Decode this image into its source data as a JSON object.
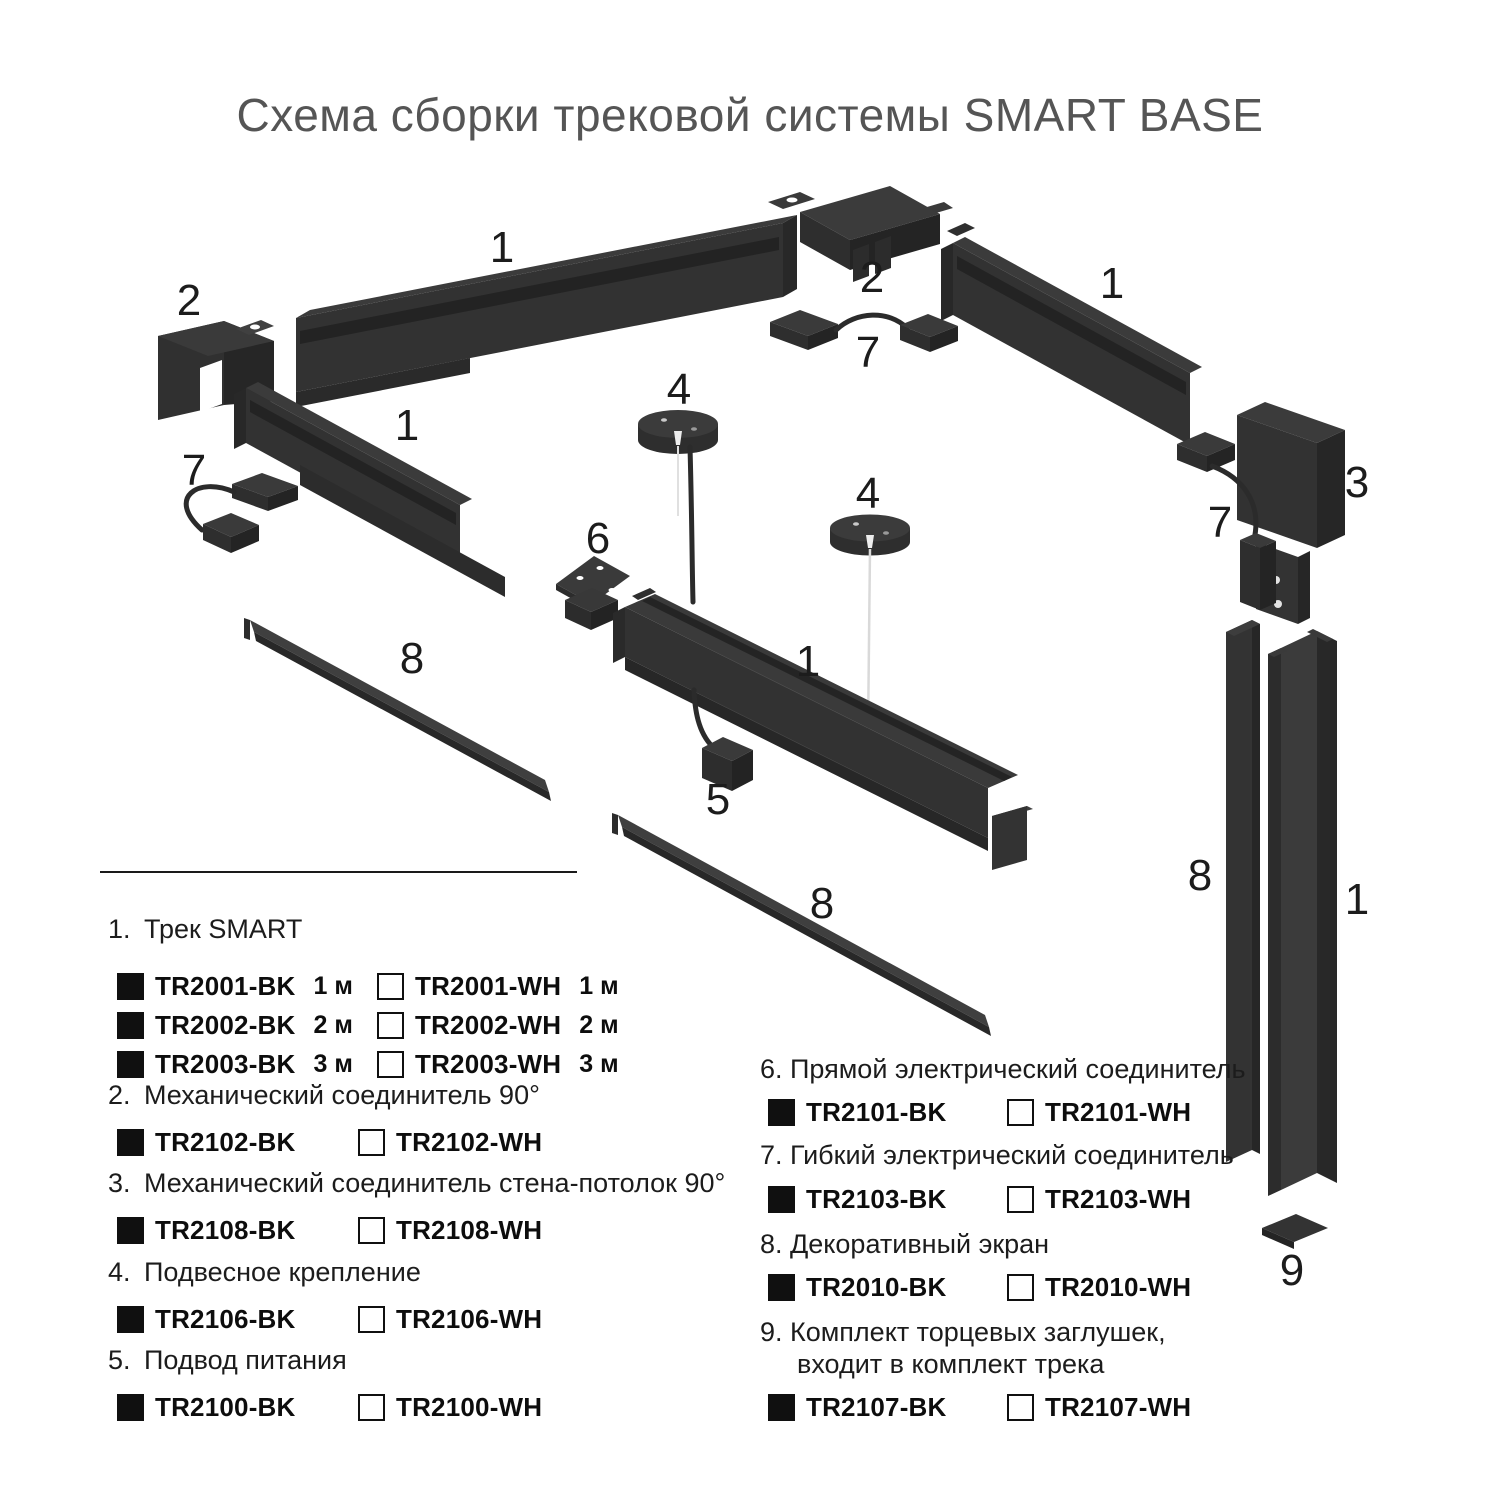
{
  "title": "Схема сборки трековой системы SMART BASE",
  "colors": {
    "part_front": "#323232",
    "part_top": "#3b3b3b",
    "part_shadow": "#262626",
    "swatch_black": "#101010",
    "swatch_white_border": "#101010",
    "cable_white": "#d9d9d9",
    "wire_black": "#2b2b2b",
    "text": "#1c1c1c",
    "title_gray": "#555555"
  },
  "diagram": {
    "labels": [
      {
        "n": "1"
      },
      {
        "n": "2"
      },
      {
        "n": "2"
      },
      {
        "n": "1"
      },
      {
        "n": "7"
      },
      {
        "n": "4"
      },
      {
        "n": "1"
      },
      {
        "n": "7"
      },
      {
        "n": "3"
      },
      {
        "n": "4"
      },
      {
        "n": "7"
      },
      {
        "n": "6"
      },
      {
        "n": "8"
      },
      {
        "n": "1"
      },
      {
        "n": "5"
      },
      {
        "n": "8"
      },
      {
        "n": "8"
      },
      {
        "n": "1"
      },
      {
        "n": "9"
      }
    ]
  },
  "legend": {
    "sections": [
      {
        "num": "1.",
        "name": "Трек SMART",
        "rows": [
          {
            "bk_code": "TR2001-BK",
            "bk_size": "1 м",
            "wh_code": "TR2001-WH",
            "wh_size": "1 м"
          },
          {
            "bk_code": "TR2002-BK",
            "bk_size": "2 м",
            "wh_code": "TR2002-WH",
            "wh_size": "2 м"
          },
          {
            "bk_code": "TR2003-BK",
            "bk_size": "3 м",
            "wh_code": "TR2003-WH",
            "wh_size": "3 м"
          }
        ]
      },
      {
        "num": "2.",
        "name": "Механический соединитель 90°",
        "rows": [
          {
            "bk_code": "TR2102-BK",
            "wh_code": "TR2102-WH"
          }
        ]
      },
      {
        "num": "3.",
        "name": "Механический соединитель стена-потолок 90°",
        "rows": [
          {
            "bk_code": "TR2108-BK",
            "wh_code": "TR2108-WH"
          }
        ]
      },
      {
        "num": "4.",
        "name": "Подвесное крепление",
        "rows": [
          {
            "bk_code": "TR2106-BK",
            "wh_code": "TR2106-WH"
          }
        ]
      },
      {
        "num": "5.",
        "name": "Подвод питания",
        "rows": [
          {
            "bk_code": "TR2100-BK",
            "wh_code": "TR2100-WH"
          }
        ]
      },
      {
        "num": "6.",
        "name": "Прямой электрический соединитель",
        "rows": [
          {
            "bk_code": "TR2101-BK",
            "wh_code": "TR2101-WH"
          }
        ]
      },
      {
        "num": "7.",
        "name": "Гибкий электрический соединитель",
        "rows": [
          {
            "bk_code": "TR2103-BK",
            "wh_code": "TR2103-WH"
          }
        ]
      },
      {
        "num": "8.",
        "name": "Декоративный экран",
        "rows": [
          {
            "bk_code": "TR2010-BK",
            "wh_code": "TR2010-WH"
          }
        ]
      },
      {
        "num": "9.",
        "name": "Комплект торцевых заглушек,",
        "name2": "входит в комплект трека",
        "rows": [
          {
            "bk_code": "TR2107-BK",
            "wh_code": "TR2107-WH"
          }
        ]
      }
    ]
  }
}
